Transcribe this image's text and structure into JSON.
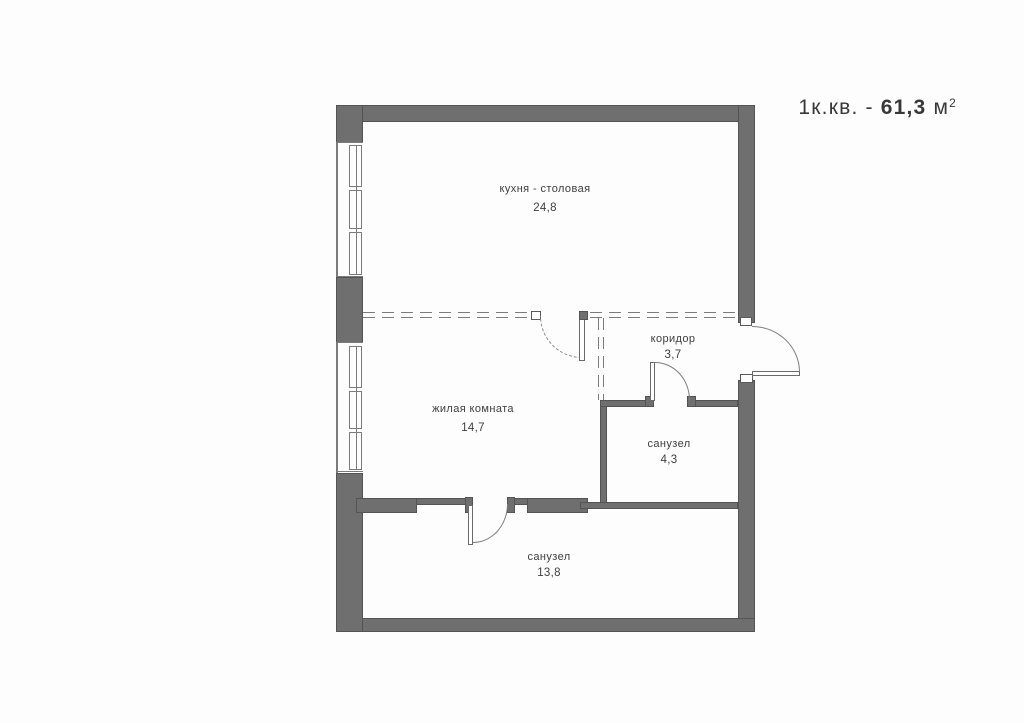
{
  "title": {
    "prefix": "1к.кв. - ",
    "area_bold": "61,3",
    "unit": " м",
    "sup": "2"
  },
  "rooms": [
    {
      "id": "kitchen",
      "name": "кухня - столовая",
      "area": "24,8"
    },
    {
      "id": "living",
      "name": "жилая комната",
      "area": "14,7"
    },
    {
      "id": "corridor",
      "name": "коридор",
      "area": "3,7"
    },
    {
      "id": "bathroom",
      "name": "санузел",
      "area": "4,3"
    },
    {
      "id": "bathroom-2",
      "name": "санузел",
      "area": "13,8"
    }
  ],
  "colors": {
    "wall": "#6f6f6f",
    "wall_edge": "#545454",
    "line": "#7b7b7b",
    "text": "#3e3e3e",
    "background": "#fdfdfd"
  }
}
